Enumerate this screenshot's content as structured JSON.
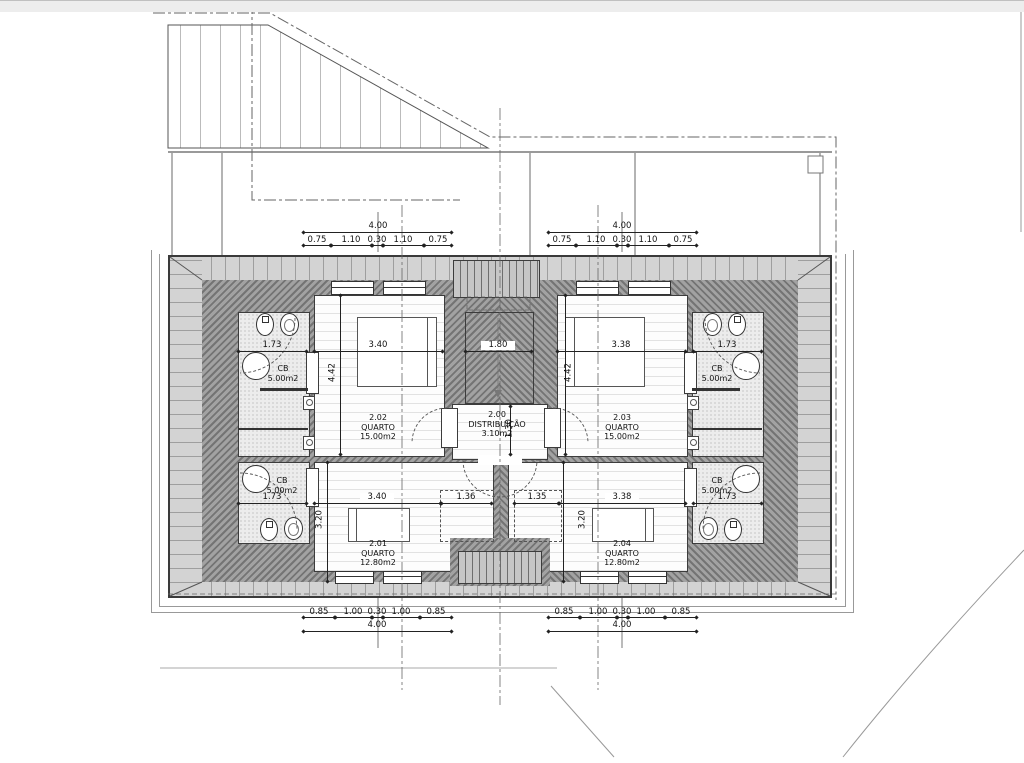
{
  "drawing": {
    "type": "floor-plan",
    "level_prefix": "2"
  },
  "rooms": {
    "distribution": {
      "number": "2.00",
      "name": "DISTRIBUIÇÃO",
      "area": "3.10m2"
    },
    "bedroom_01": {
      "number": "2.01",
      "name": "QUARTO",
      "area": "12.80m2"
    },
    "bedroom_02": {
      "number": "2.02",
      "name": "QUARTO",
      "area": "15.00m2"
    },
    "bedroom_03": {
      "number": "2.03",
      "name": "QUARTO",
      "area": "15.00m2"
    },
    "bedroom_04": {
      "number": "2.04",
      "name": "QUARTO",
      "area": "12.80m2"
    },
    "bathroom": {
      "name": "CB",
      "area": "5.00m2"
    }
  },
  "dims": {
    "top_total": "4.00",
    "top_segments": [
      "0.75",
      "1.10",
      "0.30",
      "1.10",
      "0.75"
    ],
    "bottom_total": "4.00",
    "bottom_segments": [
      "0.85",
      "1.00",
      "0.30",
      "1.00",
      "0.85"
    ],
    "bed_width_upper_left": "3.40",
    "bed_width_upper_right": "3.38",
    "bed_width_lower_left": "3.40",
    "bed_width_lower_right": "3.38",
    "stair_width": "1.80",
    "hall_depth": "1.30",
    "upper_room_depth": "4.42",
    "lower_room_depth": "3.20",
    "wardrobe_left": "1.36",
    "wardrobe_right": "1.35",
    "bath_width": "1.73"
  },
  "colors": {
    "roof_band": "#d3d3d3",
    "wall_hatch": "#8a8a8a",
    "tile": "#ececec",
    "line": "#333333"
  }
}
